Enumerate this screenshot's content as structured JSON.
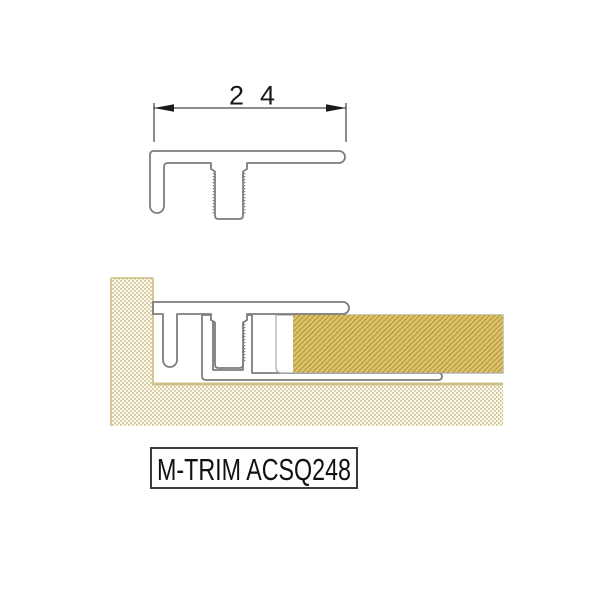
{
  "top_view": {
    "dimension_label": "24"
  },
  "product_label": {
    "text": "M-TRIM ACSQ248"
  },
  "colors": {
    "outline": "#7d7d7d",
    "dimension": "#1a1a1a",
    "slab_outline": "#a8a8a8",
    "stipple_dot": "#ccbf8a",
    "stipple_bg": "#fdfbf1",
    "stipple_border": "#c9b97e",
    "floor_top_line": "#cfc087",
    "hatch_base": "#d8bc60",
    "hatch_dark_line": "#b3973c",
    "hatch_light_line": "#e2cc7f",
    "label_border": "#3c3c3c"
  }
}
